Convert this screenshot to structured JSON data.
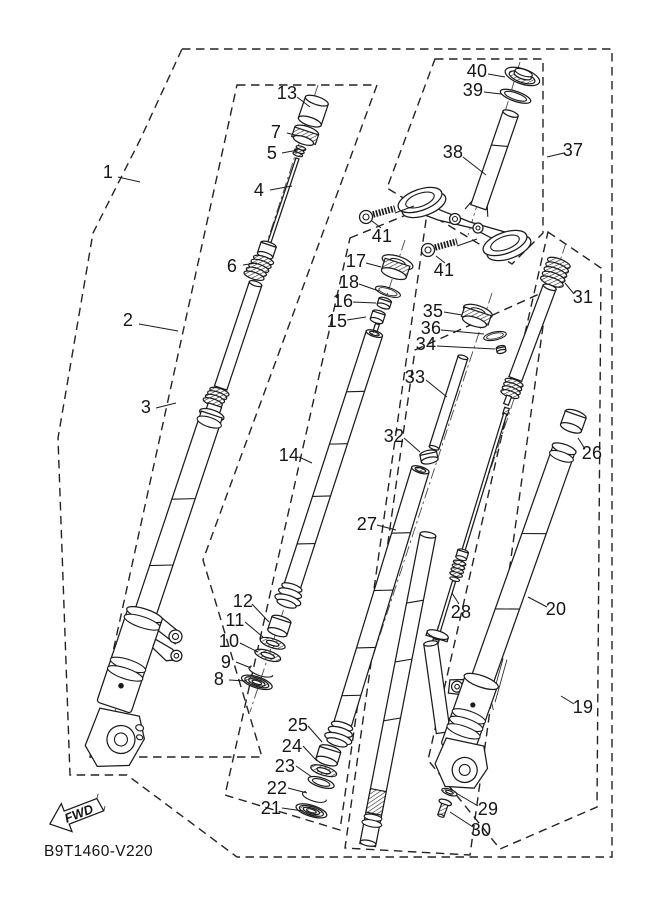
{
  "diagram": {
    "code": "B9T1460-V220",
    "fwd": "FWD",
    "colors": {
      "background": "#ffffff",
      "line": "#1b1b1b"
    },
    "icons": {
      "fwd_arrow": "left-arrow"
    }
  },
  "parts": [
    {
      "num": "1"
    },
    {
      "num": "2"
    },
    {
      "num": "3"
    },
    {
      "num": "4"
    },
    {
      "num": "5"
    },
    {
      "num": "6"
    },
    {
      "num": "7"
    },
    {
      "num": "8"
    },
    {
      "num": "9"
    },
    {
      "num": "10"
    },
    {
      "num": "11"
    },
    {
      "num": "12"
    },
    {
      "num": "13"
    },
    {
      "num": "14"
    },
    {
      "num": "15"
    },
    {
      "num": "16"
    },
    {
      "num": "17"
    },
    {
      "num": "18"
    },
    {
      "num": "19"
    },
    {
      "num": "20"
    },
    {
      "num": "21"
    },
    {
      "num": "22"
    },
    {
      "num": "23"
    },
    {
      "num": "24"
    },
    {
      "num": "25"
    },
    {
      "num": "26"
    },
    {
      "num": "27"
    },
    {
      "num": "28"
    },
    {
      "num": "29"
    },
    {
      "num": "30"
    },
    {
      "num": "31"
    },
    {
      "num": "32"
    },
    {
      "num": "33"
    },
    {
      "num": "34"
    },
    {
      "num": "35"
    },
    {
      "num": "36"
    },
    {
      "num": "37"
    },
    {
      "num": "38"
    },
    {
      "num": "39"
    },
    {
      "num": "40"
    },
    {
      "num": "41"
    },
    {
      "num": "41"
    }
  ]
}
